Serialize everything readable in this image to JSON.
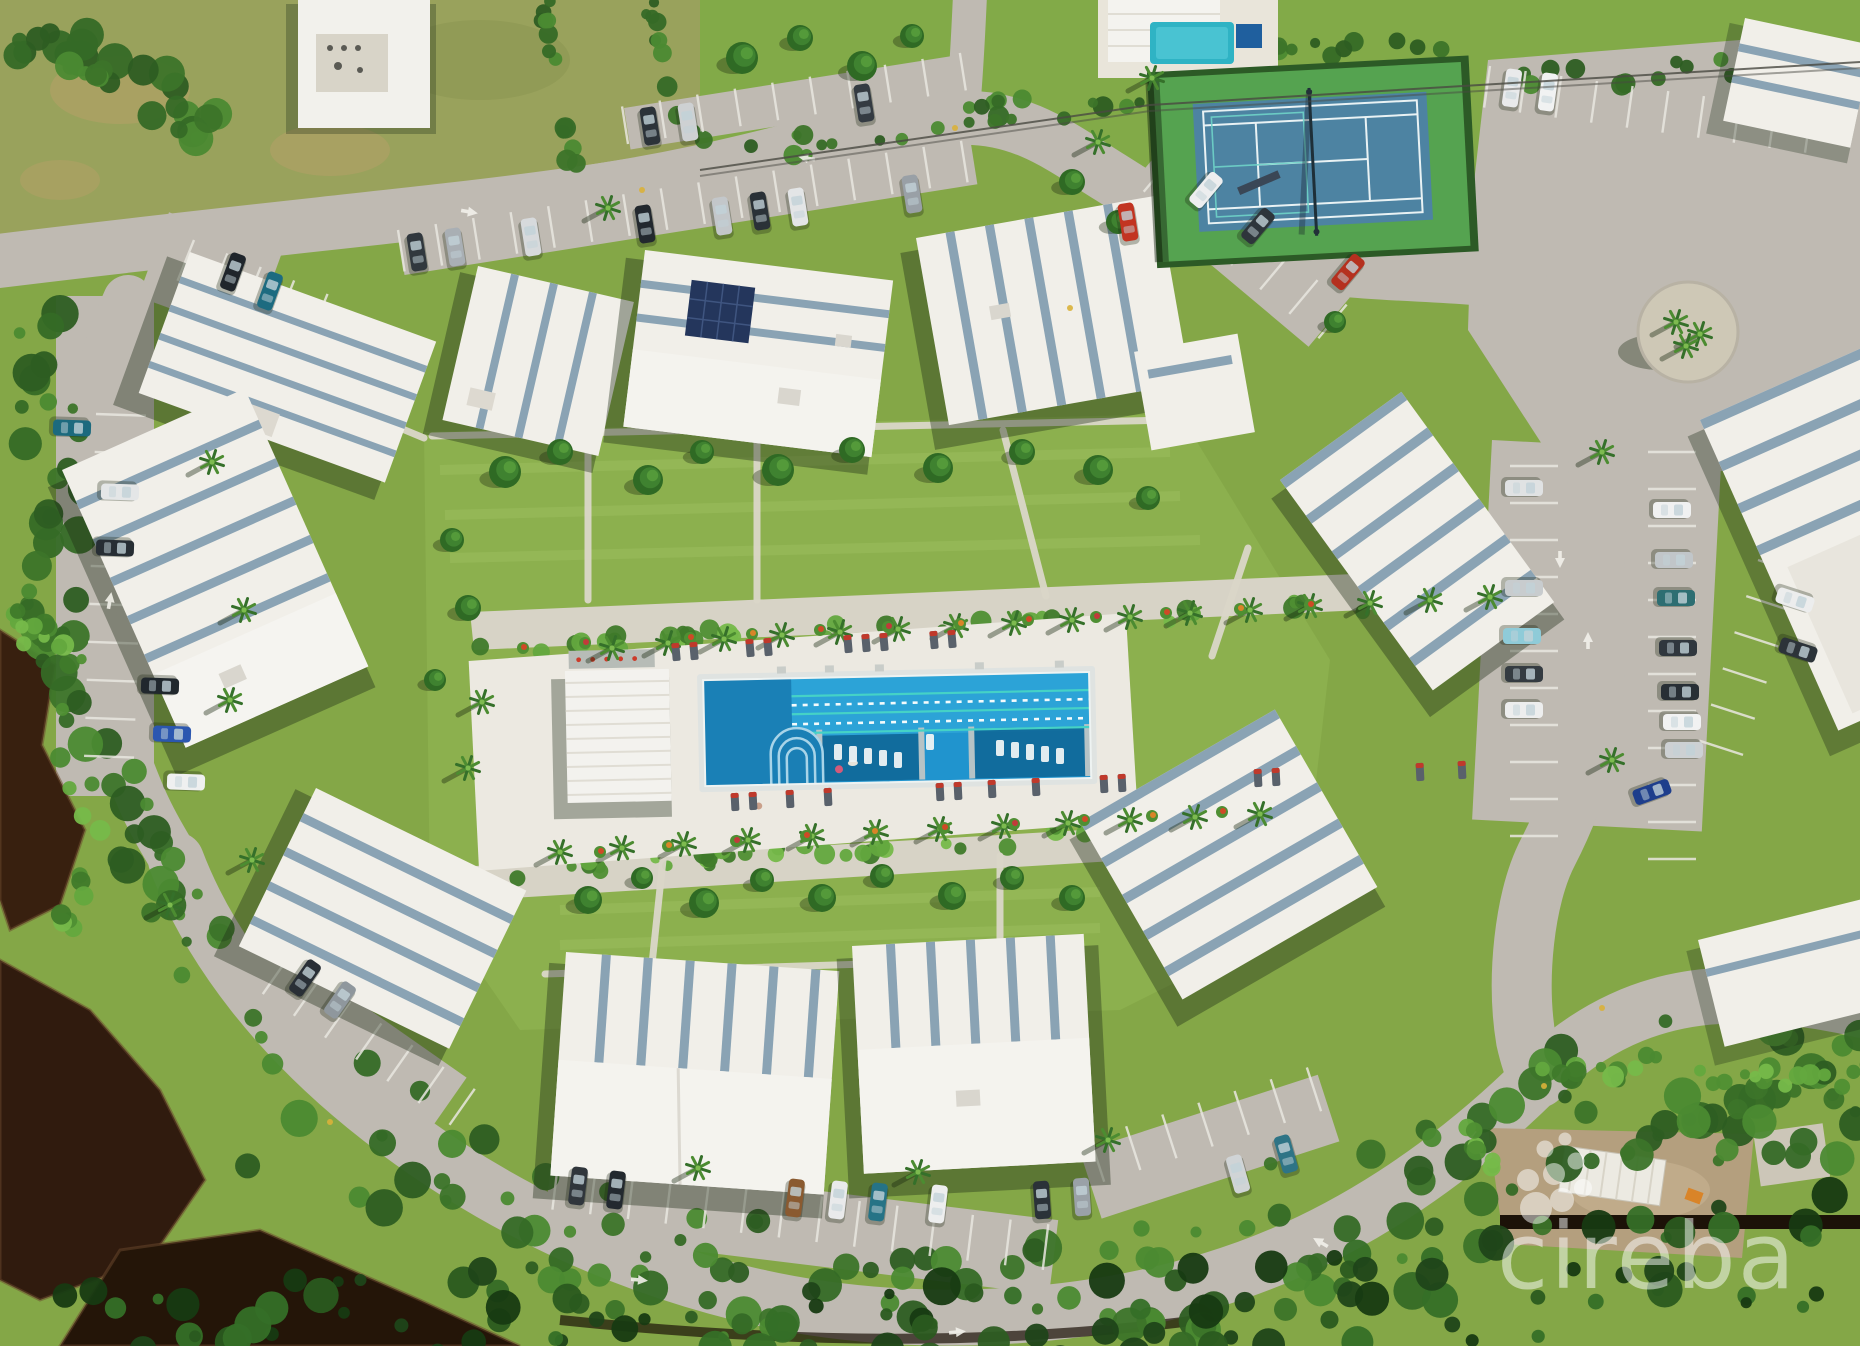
{
  "watermark": {
    "text": "cireba",
    "icon": "dot-cluster-logo",
    "color": "#ffffff",
    "opacity": 0.5
  },
  "palette": {
    "grass": "#84a747",
    "lawn": "#8cb04e",
    "scrub_field": "#99a25c",
    "road": "#bfbab2",
    "roof_white": "#f1efe9",
    "roof_accent": "#8aa3b4",
    "pool_blue": "#2094ce",
    "pool_entry": "#1a80b6",
    "lane_turquoise": "#45d2c6",
    "tennis_green": "#55a350",
    "tennis_court_blue": "#4d83a2",
    "pond_water": "#38200f",
    "mangrove_dark": "#2d5d22",
    "deck_white": "#ece9e1",
    "dirt": "#b49f7e",
    "solar_panel": "#24365c"
  },
  "scene": {
    "canopy_palettes": [
      [
        "#2d5d22",
        "#3c7429",
        "#4b8a31",
        "#356a26"
      ],
      [
        "#4f8f33",
        "#63a83e",
        "#3f7a2a",
        "#76b94a"
      ],
      [
        "#1f4519",
        "#2a5a1f",
        "#173a12",
        "#356f27"
      ]
    ],
    "canopy_bands": [
      [
        [
          [
            28,
            312
          ],
          [
            58,
            452
          ],
          [
            48,
            600
          ],
          [
            88,
            742
          ],
          [
            148,
            862
          ],
          [
            228,
            952
          ]
        ],
        72,
        60,
        7,
        0
      ],
      [
        [
          [
            248,
            1036
          ],
          [
            408,
            1158
          ],
          [
            620,
            1262
          ],
          [
            880,
            1318
          ],
          [
            1160,
            1302
          ],
          [
            1414,
            1198
          ],
          [
            1588,
            1096
          ],
          [
            1800,
            1084
          ],
          [
            1860,
            1096
          ]
        ],
        150,
        170,
        11,
        0
      ],
      [
        [
          [
            60,
            1346
          ],
          [
            400,
            1330
          ],
          [
            800,
            1346
          ],
          [
            1200,
            1330
          ],
          [
            1600,
            1280
          ],
          [
            1860,
            1240
          ]
        ],
        120,
        120,
        23,
        2
      ],
      [
        [
          [
            472,
            650
          ],
          [
            800,
            632
          ],
          [
            1150,
            616
          ],
          [
            1500,
            598
          ]
        ],
        16,
        46,
        31,
        1
      ],
      [
        [
          [
            500,
            872
          ],
          [
            900,
            846
          ],
          [
            1300,
            822
          ]
        ],
        16,
        40,
        41,
        1
      ],
      [
        [
          [
            700,
            162
          ],
          [
            1000,
            110
          ],
          [
            1300,
            94
          ],
          [
            1600,
            74
          ],
          [
            1860,
            62
          ]
        ],
        24,
        60,
        53,
        0
      ],
      [
        [
          [
            8,
            36
          ],
          [
            84,
            60
          ],
          [
            156,
            94
          ],
          [
            216,
            132
          ]
        ],
        44,
        30,
        61,
        0
      ],
      [
        [
          [
            545,
            4
          ],
          [
            560,
            110
          ],
          [
            578,
            196
          ]
        ],
        12,
        14,
        71,
        0
      ],
      [
        [
          [
            648,
            4
          ],
          [
            668,
            92
          ],
          [
            706,
            150
          ]
        ],
        12,
        12,
        83,
        0
      ],
      [
        [
          [
            1156,
            62
          ],
          [
            1300,
            50
          ],
          [
            1462,
            46
          ]
        ],
        14,
        20,
        91,
        0
      ],
      [
        [
          [
            1520,
            1070
          ],
          [
            1700,
            1076
          ],
          [
            1860,
            1082
          ]
        ],
        14,
        20,
        101,
        1
      ],
      [
        [
          [
            20,
            620
          ],
          [
            70,
            660
          ],
          [
            60,
            760
          ],
          [
            100,
            840
          ],
          [
            70,
            920
          ]
        ],
        26,
        24,
        113,
        1
      ],
      [
        [
          [
            1470,
            1130
          ],
          [
            1500,
            1190
          ]
        ],
        20,
        8,
        131,
        1
      ]
    ],
    "stall_rows": [
      [
        398,
        230,
        -9,
        15,
        38,
        42
      ],
      [
        628,
        144,
        -9,
        9,
        38,
        -38
      ],
      [
        1172,
        158,
        40,
        6,
        38,
        44
      ],
      [
        1490,
        66,
        8,
        9,
        36,
        42
      ],
      [
        1558,
        466,
        90,
        10,
        37,
        48
      ],
      [
        1648,
        452,
        90,
        11,
        37,
        -48
      ],
      [
        288,
        958,
        35,
        6,
        38,
        44
      ],
      [
        558,
        1164,
        7,
        13,
        38,
        46
      ],
      [
        1090,
        1138,
        -18,
        6,
        38,
        46
      ],
      [
        96,
        414,
        92,
        9,
        38,
        -50
      ],
      [
        194,
        240,
        22,
        4,
        36,
        44
      ],
      [
        1758,
        560,
        108,
        5,
        38,
        -46
      ]
    ],
    "cars": [
      [
        417,
        252,
        -9,
        "#31383e"
      ],
      [
        455,
        247,
        -9,
        "#a9afb4"
      ],
      [
        531,
        237,
        -9,
        "#d7dadc"
      ],
      [
        645,
        224,
        -9,
        "#22282e"
      ],
      [
        722,
        216,
        -9,
        "#c3c7ca"
      ],
      [
        760,
        211,
        -9,
        "#2a3137"
      ],
      [
        798,
        207,
        -9,
        "#e3e5e6"
      ],
      [
        912,
        194,
        -9,
        "#99a0a6"
      ],
      [
        650,
        126,
        -9,
        "#2c3339"
      ],
      [
        688,
        122,
        -9,
        "#ced1d3"
      ],
      [
        864,
        103,
        -9,
        "#343b42"
      ],
      [
        233,
        272,
        20,
        "#1f252b"
      ],
      [
        270,
        291,
        20,
        "#1d6b80"
      ],
      [
        1206,
        190,
        40,
        "#edeeef"
      ],
      [
        1258,
        226,
        40,
        "#2e353b"
      ],
      [
        1348,
        272,
        40,
        "#b5301f"
      ],
      [
        1128,
        222,
        -9,
        "#c23421"
      ],
      [
        1512,
        88,
        8,
        "#e9eaeb"
      ],
      [
        1548,
        92,
        8,
        "#f1f2f2"
      ],
      [
        1524,
        488,
        90,
        "#e0e2e3"
      ],
      [
        1524,
        588,
        90,
        "#c8ccce"
      ],
      [
        1522,
        636,
        90,
        "#8fcbd8"
      ],
      [
        1524,
        674,
        90,
        "#343b41"
      ],
      [
        1524,
        710,
        90,
        "#edeeee"
      ],
      [
        1672,
        510,
        90,
        "#f0f1f1"
      ],
      [
        1674,
        560,
        90,
        "#c1c6c9"
      ],
      [
        1676,
        598,
        90,
        "#2d6e72"
      ],
      [
        1678,
        648,
        90,
        "#30373e"
      ],
      [
        1680,
        692,
        90,
        "#282f35"
      ],
      [
        1682,
        722,
        90,
        "#f1f2f2"
      ],
      [
        1684,
        750,
        90,
        "#cdd1d3"
      ],
      [
        1652,
        792,
        70,
        "#1e3e8c"
      ],
      [
        305,
        978,
        35,
        "#292f36"
      ],
      [
        340,
        1000,
        35,
        "#8f979d"
      ],
      [
        578,
        1186,
        7,
        "#30363c"
      ],
      [
        616,
        1190,
        7,
        "#23292f"
      ],
      [
        795,
        1198,
        7,
        "#8a5a30"
      ],
      [
        838,
        1200,
        7,
        "#e9eaeb"
      ],
      [
        878,
        1202,
        7,
        "#267386"
      ],
      [
        938,
        1204,
        7,
        "#edeeee"
      ],
      [
        1042,
        1200,
        -4,
        "#2b3238"
      ],
      [
        1082,
        1197,
        -4,
        "#9aa1a7"
      ],
      [
        1238,
        1174,
        -16,
        "#d0d4d6"
      ],
      [
        1286,
        1154,
        -16,
        "#2e7486"
      ],
      [
        72,
        428,
        92,
        "#1c6a7e"
      ],
      [
        120,
        492,
        92,
        "#e4e6e7"
      ],
      [
        115,
        548,
        92,
        "#272e34"
      ],
      [
        160,
        686,
        92,
        "#20272d"
      ],
      [
        172,
        734,
        92,
        "#2b57b0"
      ],
      [
        186,
        782,
        92,
        "#eff0f0"
      ],
      [
        1795,
        600,
        108,
        "#eceded"
      ],
      [
        1798,
        650,
        108,
        "#2c3339"
      ]
    ],
    "trees": [
      [
        505,
        472,
        16
      ],
      [
        560,
        452,
        13
      ],
      [
        648,
        480,
        15
      ],
      [
        702,
        452,
        12
      ],
      [
        778,
        470,
        16
      ],
      [
        852,
        450,
        13
      ],
      [
        938,
        468,
        15
      ],
      [
        1022,
        452,
        13
      ],
      [
        1098,
        470,
        15
      ],
      [
        1148,
        498,
        12
      ],
      [
        452,
        540,
        12
      ],
      [
        468,
        608,
        13
      ],
      [
        435,
        680,
        11
      ],
      [
        588,
        900,
        14
      ],
      [
        642,
        878,
        11
      ],
      [
        704,
        903,
        15
      ],
      [
        762,
        880,
        12
      ],
      [
        822,
        898,
        14
      ],
      [
        882,
        876,
        12
      ],
      [
        952,
        896,
        14
      ],
      [
        1012,
        878,
        12
      ],
      [
        1072,
        898,
        13
      ],
      [
        742,
        58,
        16
      ],
      [
        800,
        38,
        13
      ],
      [
        862,
        66,
        15
      ],
      [
        912,
        36,
        12
      ],
      [
        1072,
        182,
        13
      ],
      [
        1118,
        222,
        12
      ],
      [
        1335,
        322,
        11
      ]
    ],
    "palms": [
      [
        612,
        648
      ],
      [
        668,
        643
      ],
      [
        724,
        639
      ],
      [
        782,
        635
      ],
      [
        840,
        632
      ],
      [
        898,
        629
      ],
      [
        956,
        626
      ],
      [
        1014,
        623
      ],
      [
        1072,
        620
      ],
      [
        1130,
        617
      ],
      [
        1190,
        613
      ],
      [
        1250,
        610
      ],
      [
        1310,
        606
      ],
      [
        1370,
        603
      ],
      [
        1430,
        600
      ],
      [
        1490,
        597
      ],
      [
        560,
        852
      ],
      [
        622,
        848
      ],
      [
        684,
        844
      ],
      [
        748,
        840
      ],
      [
        812,
        836
      ],
      [
        876,
        832
      ],
      [
        940,
        829
      ],
      [
        1004,
        826
      ],
      [
        1068,
        823
      ],
      [
        1130,
        820
      ],
      [
        1195,
        817
      ],
      [
        1260,
        814
      ],
      [
        212,
        462
      ],
      [
        244,
        610
      ],
      [
        230,
        700
      ],
      [
        252,
        860
      ],
      [
        170,
        905
      ],
      [
        608,
        208
      ],
      [
        1098,
        142
      ],
      [
        1152,
        78
      ],
      [
        1676,
        322
      ],
      [
        1700,
        334
      ],
      [
        1686,
        346
      ],
      [
        698,
        1168
      ],
      [
        918,
        1172
      ],
      [
        1108,
        1140
      ],
      [
        1602,
        452
      ],
      [
        1612,
        760
      ],
      [
        482,
        702
      ],
      [
        468,
        768
      ]
    ],
    "flowers": [
      [
        690,
        638,
        "#cf4a26"
      ],
      [
        752,
        634,
        "#d98428"
      ],
      [
        820,
        630,
        "#cf4a26"
      ],
      [
        888,
        627,
        "#c23a3a"
      ],
      [
        960,
        624,
        "#d98428"
      ],
      [
        1028,
        620,
        "#cf4a26"
      ],
      [
        1096,
        617,
        "#c23a3a"
      ],
      [
        1166,
        613,
        "#cf4a26"
      ],
      [
        1240,
        609,
        "#d98428"
      ],
      [
        1310,
        605,
        "#cf4a26"
      ],
      [
        585,
        643,
        "#c23a3a"
      ],
      [
        523,
        648,
        "#cf4a26"
      ],
      [
        600,
        852,
        "#cf4a26"
      ],
      [
        668,
        846,
        "#d98428"
      ],
      [
        736,
        841,
        "#c23a3a"
      ],
      [
        806,
        836,
        "#cf4a26"
      ],
      [
        874,
        832,
        "#d98428"
      ],
      [
        944,
        828,
        "#cf4a26"
      ],
      [
        1014,
        824,
        "#c23a3a"
      ],
      [
        1084,
        820,
        "#cf4a26"
      ],
      [
        1152,
        816,
        "#d98428"
      ],
      [
        1222,
        812,
        "#cf4a26"
      ]
    ],
    "deck_loungers": [
      [
        676,
        652,
        -5
      ],
      [
        694,
        651,
        -5
      ],
      [
        750,
        648,
        -5
      ],
      [
        768,
        647,
        -5
      ],
      [
        848,
        644,
        -5
      ],
      [
        866,
        643,
        -5
      ],
      [
        884,
        642,
        -5
      ],
      [
        934,
        640,
        -5
      ],
      [
        952,
        639,
        -5
      ],
      [
        735,
        802,
        -3
      ],
      [
        753,
        801,
        -3
      ],
      [
        790,
        799,
        -3
      ],
      [
        828,
        797,
        -3
      ],
      [
        940,
        792,
        -3
      ],
      [
        958,
        791,
        -3
      ],
      [
        992,
        789,
        -3
      ],
      [
        1036,
        787,
        -3
      ],
      [
        1104,
        784,
        -3
      ],
      [
        1122,
        783,
        -3
      ],
      [
        1258,
        778,
        -3
      ],
      [
        1276,
        777,
        -3
      ],
      [
        1420,
        772,
        -3
      ],
      [
        1462,
        770,
        -3
      ]
    ],
    "pool_loungers": [
      [
        838,
        752
      ],
      [
        853,
        754
      ],
      [
        868,
        756
      ],
      [
        883,
        758
      ],
      [
        898,
        760
      ],
      [
        930,
        742
      ],
      [
        1000,
        748
      ],
      [
        1015,
        750
      ],
      [
        1030,
        752
      ],
      [
        1045,
        754
      ],
      [
        1060,
        756
      ]
    ],
    "paths": [
      [
        588,
        446,
        588,
        600
      ],
      [
        757,
        434,
        757,
        600
      ],
      [
        1003,
        430,
        1046,
        596
      ],
      [
        432,
        436,
        1172,
        420
      ],
      [
        545,
        974,
        1058,
        958
      ],
      [
        663,
        860,
        652,
        964
      ],
      [
        1000,
        856,
        1000,
        966
      ],
      [
        198,
        344,
        424,
        438
      ],
      [
        1248,
        548,
        1212,
        656
      ]
    ],
    "arrows": [
      [
        470,
        212,
        100
      ],
      [
        806,
        158,
        -80
      ],
      [
        640,
        1280,
        95
      ],
      [
        958,
        1332,
        85
      ],
      [
        1560,
        560,
        180
      ],
      [
        1588,
        640,
        0
      ],
      [
        110,
        600,
        10
      ],
      [
        1320,
        1242,
        -60
      ]
    ],
    "road_dots": [
      [
        642,
        190
      ],
      [
        1070,
        308
      ],
      [
        955,
        128
      ],
      [
        1602,
        1008
      ],
      [
        330,
        1122
      ],
      [
        1544,
        1086
      ]
    ]
  }
}
